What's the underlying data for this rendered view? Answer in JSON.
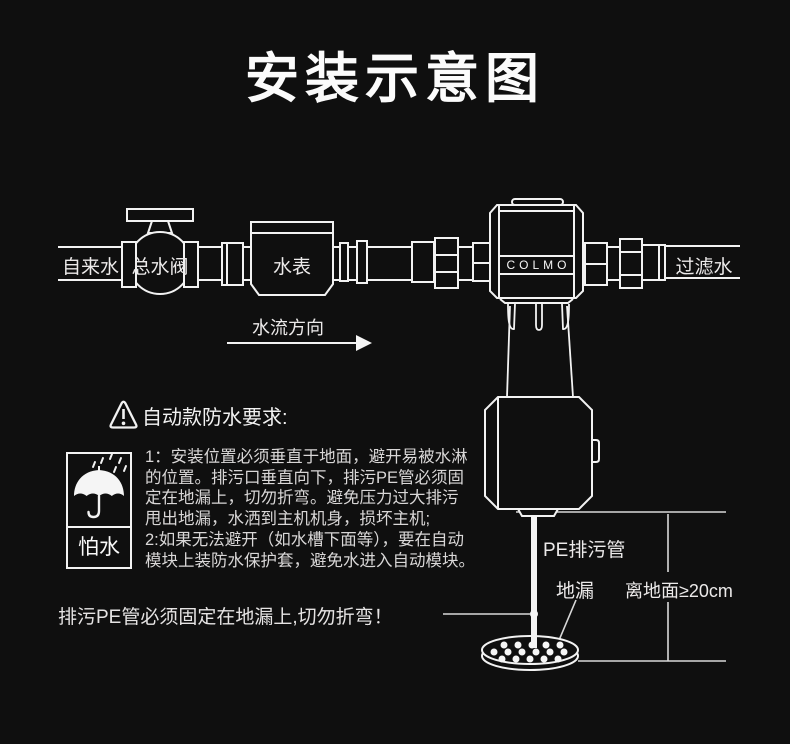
{
  "page": {
    "background": "#0f0f0f",
    "line_color": "#f2f2f2",
    "text_color": "#e9e9e9"
  },
  "title": "安装示意图",
  "pipeline": {
    "tap_water_label": "自来水",
    "main_valve_label": "总水阀",
    "water_meter_label": "水表",
    "device_brand": "COLMO",
    "filtered_water_label": "过滤水",
    "flow_direction_label": "水流方向"
  },
  "waterproof_notice": {
    "heading": "自动款防水要求:",
    "icon_caption": "怕水",
    "lines": [
      "1：安装位置必须垂直于地面，避开易被水淋",
      "的位置。排污口垂直向下，排污PE管必须固",
      "定在地漏上，切勿折弯。避免压力过大排污",
      "甩出地漏，水洒到主机机身，损坏主机;",
      "2:如果无法避开（如水槽下面等），要在自动",
      "模块上装防水保护套，避免水进入自动模块。"
    ]
  },
  "annotations": {
    "drain_fix_note": "排污PE管必须固定在地漏上,切勿折弯！",
    "pe_pipe_label": "PE排污管",
    "floor_drain_label": "地漏",
    "ground_clearance_label": "离地面≥20cm"
  }
}
